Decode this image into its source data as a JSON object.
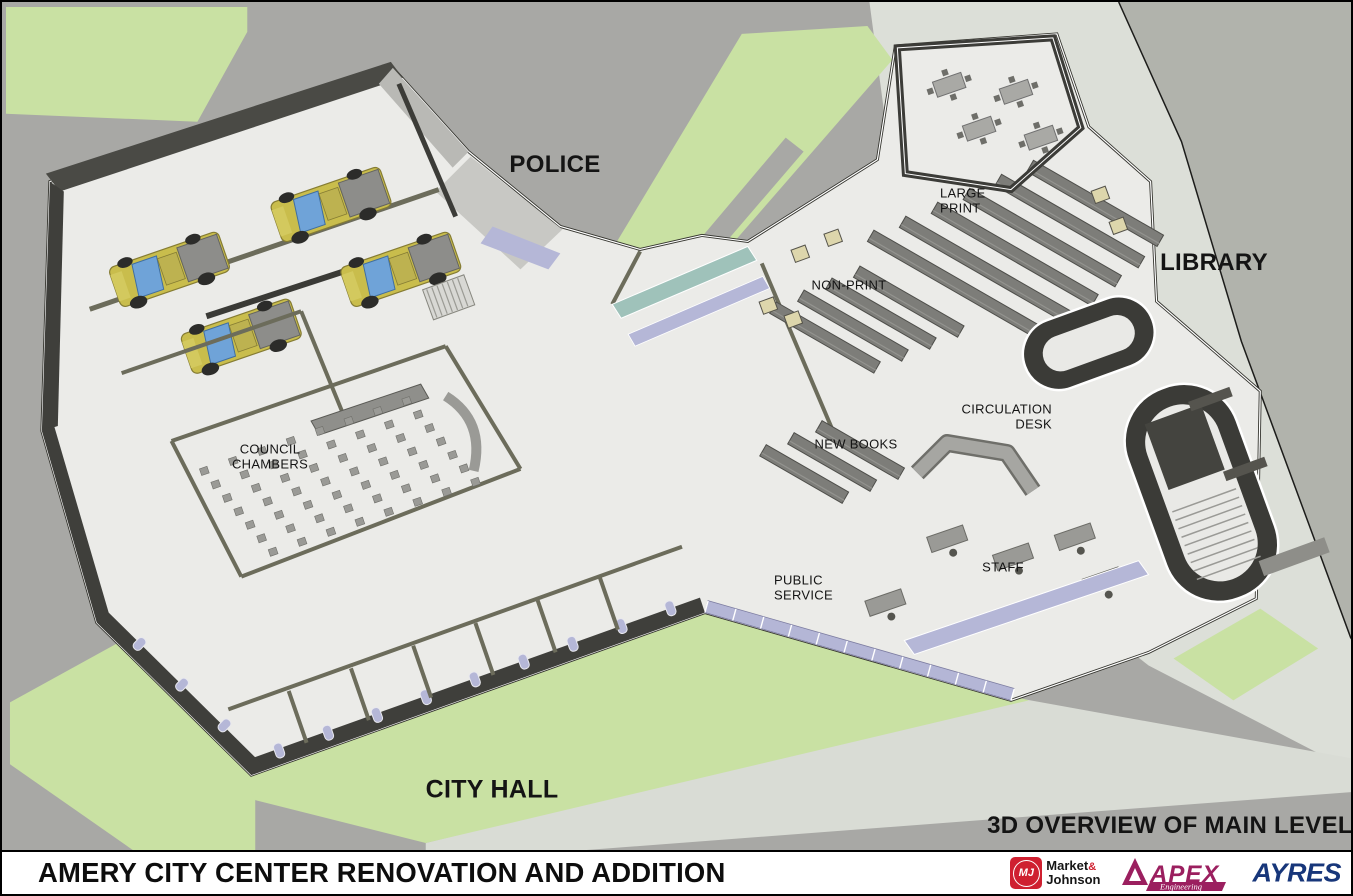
{
  "banner": {
    "title": "AMERY CITY CENTER RENOVATION AND ADDITION"
  },
  "view_caption": "3D OVERVIEW OF MAIN LEVEL",
  "area_labels": {
    "police": "POLICE",
    "library": "LIBRARY",
    "city_hall": "CITY HALL"
  },
  "room_labels": {
    "large_print": "LARGE\nPRINT",
    "non_print": "NON-PRINT",
    "circulation_desk": "CIRCULATION\nDESK",
    "new_books": "NEW BOOKS",
    "council_chambers": "COUNCIL\nCHAMBERS",
    "public_service": "PUBLIC\nSERVICE",
    "staff": "STAFF"
  },
  "logos": {
    "market_johnson": {
      "initials": "MJ",
      "line1": "Market",
      "amp": "&",
      "line2": "Johnson"
    },
    "apex": {
      "name": "APEX",
      "sub": "Engineering"
    },
    "ayres": {
      "name": "AYRES"
    }
  },
  "colors": {
    "road": "#a8a8a5",
    "sidewalk": "#dcdfd8",
    "grass": "#c9e1a3",
    "floor": "#ebebe8",
    "wall_dark": "#3c3c38",
    "wall_olive": "#6c6c5b",
    "glass_lavender": "#b5b7d7",
    "glass_teal": "#9fc2ba",
    "shelf_gray": "#7d7d79",
    "furniture_gray": "#9a9a96",
    "truck_yellow": "#c9bd4c",
    "truck_window": "#6fa3d8",
    "mj_red": "#cf2030",
    "apex_magenta": "#9b1f5f",
    "ayres_blue": "#17367a"
  }
}
